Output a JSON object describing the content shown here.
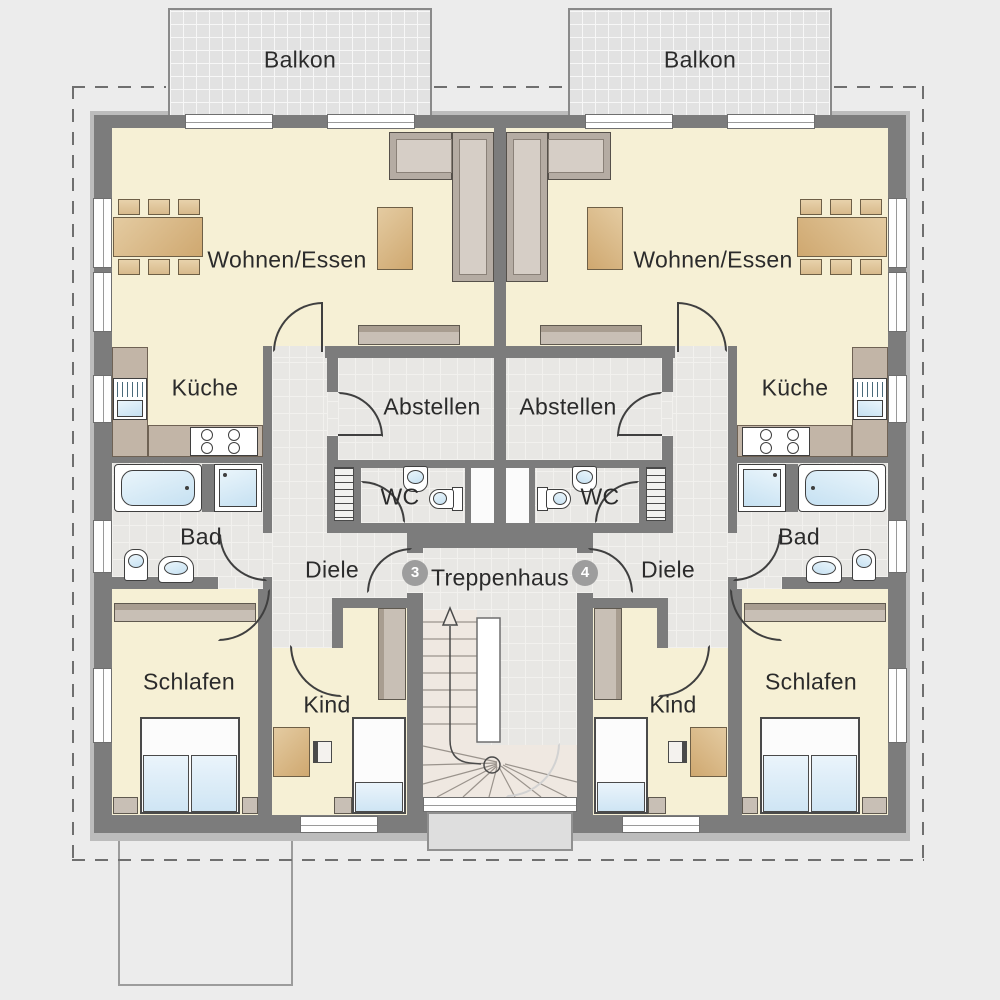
{
  "labels": {
    "balcony": "Balkon",
    "living_dining": "Wohnen/Essen",
    "kitchen": "Küche",
    "storage": "Abstellen",
    "wc": "WC",
    "bathroom": "Bad",
    "hallway": "Diele",
    "stairwell": "Treppenhaus",
    "bedroom": "Schlafen",
    "child_room": "Kind"
  },
  "units": {
    "left": "3",
    "right": "4"
  },
  "colors": {
    "background": "#ececec",
    "wall": "#7c7c7c",
    "wall_outer": "#bcbcbc",
    "floor_living": "#f6f0d5",
    "floor_tile": "#e8e7e4",
    "balcony_floor": "#e2e2e2",
    "fixture_blue": "#cfe6f4",
    "furniture_wood": "#d9b98c",
    "furniture_taupe": "#c8bfb5",
    "unit_badge": "#9d9d9d",
    "boundary_dash": "#6f6f6f"
  }
}
